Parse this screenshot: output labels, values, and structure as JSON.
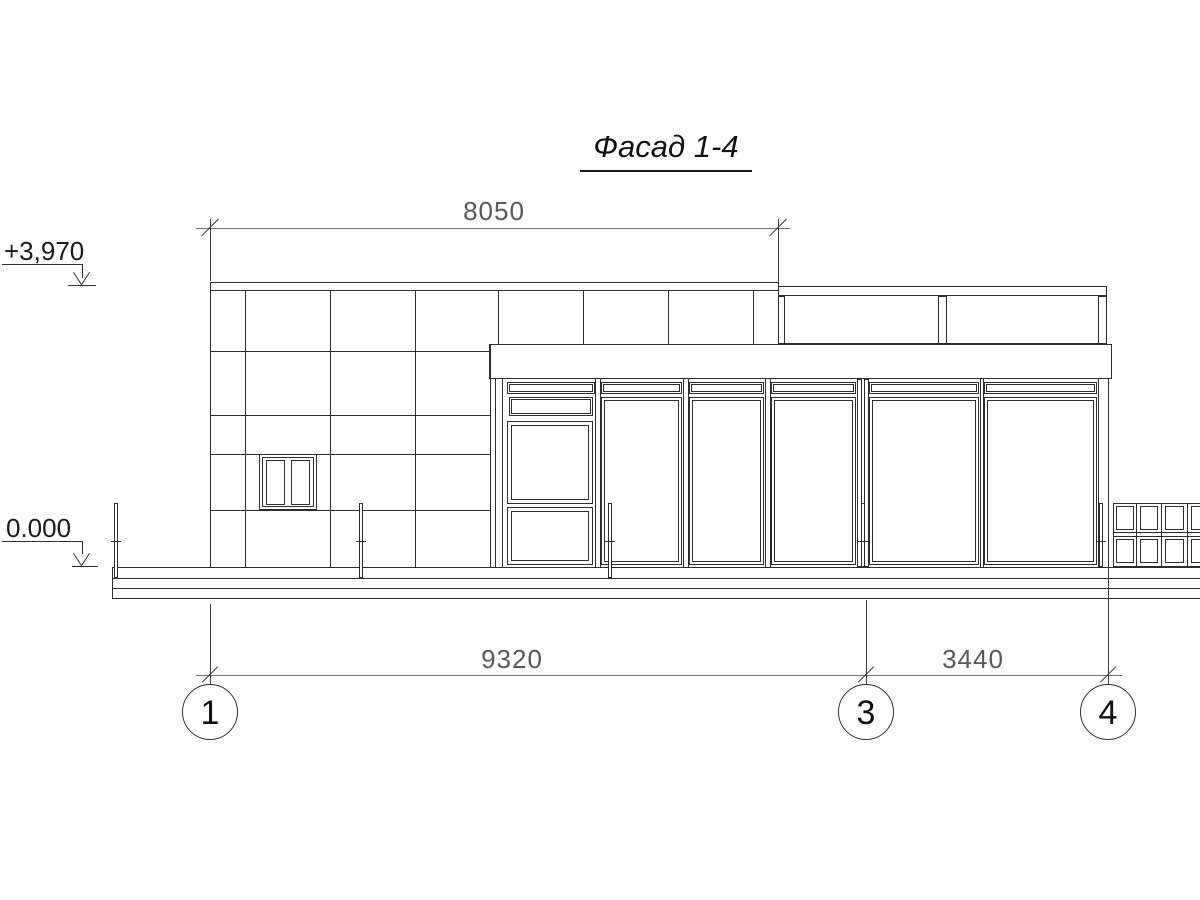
{
  "title": "Фасад 1-4",
  "dimensions": {
    "top_width": "8050",
    "bottom_span_1_3": "9320",
    "bottom_span_3_4": "3440"
  },
  "elevations": {
    "parapet": "+3,970",
    "ground": "0.000"
  },
  "axes": [
    {
      "label": "1"
    },
    {
      "label": "3"
    },
    {
      "label": "4"
    }
  ],
  "colors": {
    "line": "#2e2e2e",
    "dimension_line": "#6e6e6e",
    "dimension_text": "#585858",
    "text": "#1a1a1a",
    "background": "#ffffff"
  }
}
